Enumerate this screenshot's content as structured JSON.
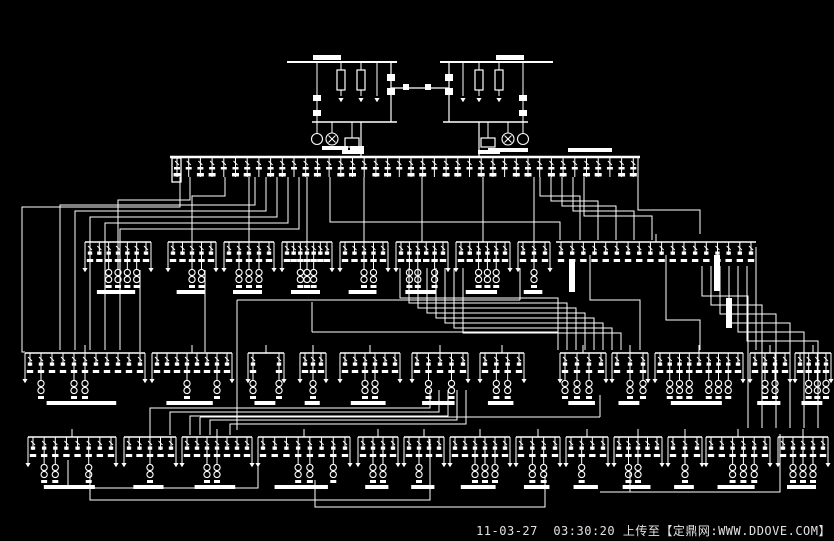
{
  "canvas": {
    "w": 834,
    "h": 541,
    "bg": "#000000",
    "line": "#ffffff"
  },
  "watermark": {
    "text": "11-03-27  03:30:20 上传至【定鼎网:WWW.DDOVE.COM】",
    "color": "#e2e2e0"
  },
  "diagram": {
    "incomers": [
      {
        "side": "left",
        "bus": [
          287,
          62,
          397
        ],
        "label_bar": [
          313,
          55,
          28,
          5
        ],
        "fuses_x": [
          341,
          361
        ],
        "arrow_drop_x": 377,
        "breaker_col_x": 391,
        "aux_col_x": 317,
        "mid_bus": [
          312,
          122,
          397
        ],
        "meter_circle": [
          332,
          139
        ],
        "device_rect": [
          345,
          138,
          14,
          9
        ],
        "device_bar": [
          342,
          150,
          22,
          4
        ],
        "down_feed_x": 361
      },
      {
        "side": "right",
        "bus": [
          440,
          62,
          553
        ],
        "label_bar": [
          496,
          55,
          28,
          5
        ],
        "fuses_x": [
          479,
          499
        ],
        "arrow_drop_x": 463,
        "breaker_col_x": 449,
        "aux_col_x": 523,
        "mid_bus": [
          443,
          122,
          528
        ],
        "meter_circle": [
          508,
          139
        ],
        "device_rect": [
          481,
          138,
          14,
          9
        ],
        "device_bar": [
          478,
          150,
          22,
          4
        ],
        "down_feed_x": 479
      }
    ],
    "tie": {
      "y": 88,
      "x1": 391,
      "x2": 449,
      "switch_rects": [
        [
          403,
          84,
          6,
          6
        ],
        [
          425,
          84,
          6,
          6
        ]
      ]
    },
    "main_bus": {
      "y": 157,
      "x1": 170,
      "x2": 640,
      "drops": 40,
      "drop_start": 177,
      "drop_step": 11.7,
      "end_device": [
        172,
        158,
        9,
        24
      ],
      "bars_above": [
        [
          322,
          146,
          26,
          4
        ],
        [
          350,
          146,
          14,
          4
        ],
        [
          488,
          148,
          40,
          4
        ],
        [
          568,
          148,
          44,
          4
        ]
      ]
    },
    "tiers": [
      {
        "y": 242,
        "panels": [
          {
            "x": 85,
            "w": 66,
            "n": 7,
            "meters": [
              2,
              3,
              4,
              5
            ]
          },
          {
            "x": 168,
            "w": 48,
            "n": 5,
            "meters": [
              2,
              3
            ]
          },
          {
            "x": 224,
            "w": 50,
            "n": 5,
            "meters": [
              1,
              2,
              3
            ]
          },
          {
            "x": 282,
            "w": 50,
            "n": 7,
            "meters": [
              2,
              3,
              4
            ]
          },
          {
            "x": 340,
            "w": 48,
            "n": 5,
            "meters": [
              2,
              3
            ]
          },
          {
            "x": 396,
            "w": 52,
            "n": 6,
            "meters": [
              1,
              2,
              4
            ]
          },
          {
            "x": 456,
            "w": 54,
            "n": 6,
            "meters": [
              2,
              3,
              4
            ]
          },
          {
            "x": 518,
            "w": 32,
            "n": 3,
            "meters": [
              1
            ]
          },
          {
            "x": 556,
            "w": 200,
            "n": 18,
            "meters": [],
            "bracket": false,
            "bar": false
          }
        ]
      },
      {
        "y": 353,
        "panels": [
          {
            "x": 25,
            "w": 120,
            "n": 11,
            "meters": [
              1,
              4,
              5
            ]
          },
          {
            "x": 152,
            "w": 80,
            "n": 8,
            "meters": [
              3,
              6
            ]
          },
          {
            "x": 248,
            "w": 36,
            "n": 2,
            "meters": [
              0,
              1
            ]
          },
          {
            "x": 300,
            "w": 26,
            "n": 3,
            "meters": [
              1
            ]
          },
          {
            "x": 340,
            "w": 60,
            "n": 6,
            "meters": [
              2,
              3
            ]
          },
          {
            "x": 412,
            "w": 56,
            "n": 5,
            "meters": [
              1,
              3
            ]
          },
          {
            "x": 480,
            "w": 44,
            "n": 4,
            "meters": [
              1,
              2
            ]
          },
          {
            "x": 560,
            "w": 46,
            "n": 4,
            "meters": [
              0,
              1,
              2
            ]
          },
          {
            "x": 612,
            "w": 36,
            "n": 3,
            "meters": [
              1,
              2
            ]
          },
          {
            "x": 655,
            "w": 88,
            "n": 9,
            "meters": [
              1,
              2,
              3,
              5,
              6,
              7
            ]
          },
          {
            "x": 750,
            "w": 40,
            "n": 4,
            "meters": [
              1,
              2
            ]
          },
          {
            "x": 795,
            "w": 36,
            "n": 4,
            "meters": [
              1,
              2,
              3
            ]
          }
        ]
      },
      {
        "y": 437,
        "panels": [
          {
            "x": 28,
            "w": 88,
            "n": 8,
            "meters": [
              1,
              2,
              5
            ]
          },
          {
            "x": 124,
            "w": 52,
            "n": 5,
            "meters": [
              2
            ]
          },
          {
            "x": 182,
            "w": 70,
            "n": 7,
            "meters": [
              2,
              3
            ]
          },
          {
            "x": 258,
            "w": 92,
            "n": 8,
            "meters": [
              3,
              4,
              6
            ]
          },
          {
            "x": 358,
            "w": 40,
            "n": 4,
            "meters": [
              1,
              2
            ]
          },
          {
            "x": 404,
            "w": 40,
            "n": 4,
            "meters": [
              1
            ]
          },
          {
            "x": 450,
            "w": 60,
            "n": 6,
            "meters": [
              2,
              3,
              4
            ]
          },
          {
            "x": 516,
            "w": 44,
            "n": 4,
            "meters": [
              1,
              2
            ]
          },
          {
            "x": 566,
            "w": 42,
            "n": 4,
            "meters": [
              1
            ]
          },
          {
            "x": 614,
            "w": 48,
            "n": 5,
            "meters": [
              1,
              2
            ]
          },
          {
            "x": 668,
            "w": 34,
            "n": 3,
            "meters": [
              1
            ]
          },
          {
            "x": 706,
            "w": 64,
            "n": 6,
            "meters": [
              2,
              3,
              4
            ]
          },
          {
            "x": 778,
            "w": 50,
            "n": 5,
            "meters": [
              1,
              2,
              3
            ]
          }
        ]
      }
    ],
    "tall_rects": [
      [
        569,
        262,
        6,
        30
      ],
      [
        714,
        255,
        6,
        36
      ],
      [
        726,
        298,
        6,
        30
      ]
    ],
    "routes": [
      [
        180,
        177,
        180,
        207,
        22,
        207,
        22,
        352,
        25,
        352
      ],
      [
        307,
        177,
        307,
        234
      ],
      [
        190,
        177,
        190,
        200,
        118,
        200,
        118,
        234
      ],
      [
        225,
        177,
        225,
        196,
        192,
        196,
        192,
        234
      ],
      [
        249,
        177,
        249,
        234
      ],
      [
        364,
        177,
        364,
        234
      ],
      [
        422,
        177,
        422,
        234
      ],
      [
        483,
        177,
        483,
        234
      ],
      [
        534,
        177,
        534,
        234
      ],
      [
        638,
        157,
        638,
        210,
        700,
        210,
        700,
        234
      ],
      [
        330,
        177,
        330,
        222,
        560,
        222,
        560,
        240
      ],
      [
        237,
        300,
        237,
        430
      ],
      [
        237,
        300,
        520,
        300
      ],
      [
        520,
        268,
        520,
        300
      ],
      [
        312,
        302,
        312,
        332
      ],
      [
        312,
        332,
        558,
        332
      ],
      [
        558,
        332,
        558,
        350
      ],
      [
        200,
        417,
        600,
        417
      ],
      [
        200,
        417,
        200,
        435
      ],
      [
        600,
        395,
        600,
        417
      ],
      [
        90,
        470,
        90,
        500,
        430,
        500,
        430,
        439
      ],
      [
        68,
        460,
        68,
        488,
        258,
        488,
        258,
        439
      ],
      [
        315,
        480,
        315,
        507,
        545,
        507,
        545,
        475
      ],
      [
        600,
        492,
        780,
        492,
        780,
        434
      ],
      [
        630,
        472,
        630,
        492
      ],
      [
        756,
        247,
        756,
        350
      ],
      [
        140,
        270,
        140,
        352
      ],
      [
        205,
        270,
        205,
        352
      ],
      [
        590,
        255,
        590,
        300,
        640,
        300,
        640,
        350
      ],
      [
        666,
        255,
        666,
        320,
        700,
        320,
        700,
        350
      ]
    ],
    "bundles": [
      {
        "n": 8,
        "sx": 400,
        "sxs": 9,
        "sy": 268,
        "ty": 298,
        "tys": 5,
        "ex": 558,
        "exs": 9,
        "ey": 350
      },
      {
        "n": 6,
        "sx": 702,
        "sxs": 9,
        "sy": 266,
        "ty": 296,
        "tys": 9,
        "ex": 748,
        "exs": 14,
        "ey": 428
      },
      {
        "n": 5,
        "sx": 255,
        "sxs": 11,
        "sy": 177,
        "ty": 205,
        "tys": 6,
        "ex": 60,
        "exs": 15,
        "ey": 350
      },
      {
        "n": 5,
        "sx": 540,
        "sxs": 11,
        "sy": 177,
        "ty": 196,
        "tys": 5,
        "ex": 580,
        "exs": 18,
        "ey": 240
      },
      {
        "n": 5,
        "sx": 430,
        "sxs": 9,
        "sy": 390,
        "ty": 408,
        "tys": 4,
        "ex": 150,
        "exs": 20,
        "ey": 435
      }
    ]
  }
}
